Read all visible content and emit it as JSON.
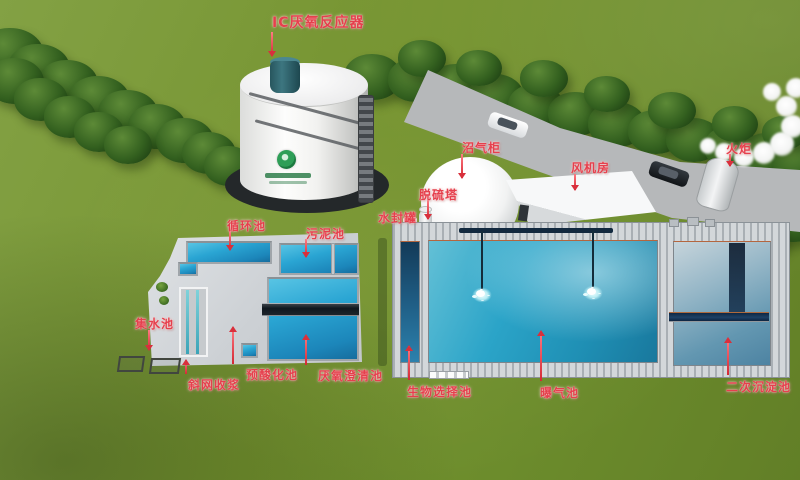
{
  "scene": {
    "description_type": "3d-plant-overview",
    "labels": {
      "ic_reactor": "IC厌氧反应器",
      "biogas_holder": "沼气柜",
      "desulfurization_tower": "脱硫塔",
      "water_seal_tank": "水封罐",
      "fan_room": "风机房",
      "flare": "火炬",
      "circulation_pool": "循环池",
      "sludge_pool": "污泥池",
      "collection_pool": "集水池",
      "screen_pulp_recovery": "斜网收浆",
      "pre_acidification_pool": "预酸化池",
      "anaerobic_clarifier": "厌氧澄清池",
      "bio_selector_pool": "生物选择池",
      "aeration_pool": "曝气池",
      "secondary_clarifier": "二次沉淀池"
    },
    "annotation_style": {
      "label_color": "#e5404d",
      "arrow_color": "#d8303c"
    },
    "palette": {
      "grass_green": "#75932f",
      "tree_green": "#33601f",
      "road_gray": "#b6b8ba",
      "concrete_gray": "#ccd0d4",
      "pool_blue": "#2aa5d3",
      "aeration_teal": "#2ba4c8",
      "clarifier_steel_blue": "#93b5c6",
      "pipe_navy": "#1d4166",
      "logo_green": "#2e9e57"
    },
    "icons": {
      "company_logo": "green-swirl-logo",
      "vehicles": [
        "white-car",
        "dark-car"
      ]
    }
  }
}
